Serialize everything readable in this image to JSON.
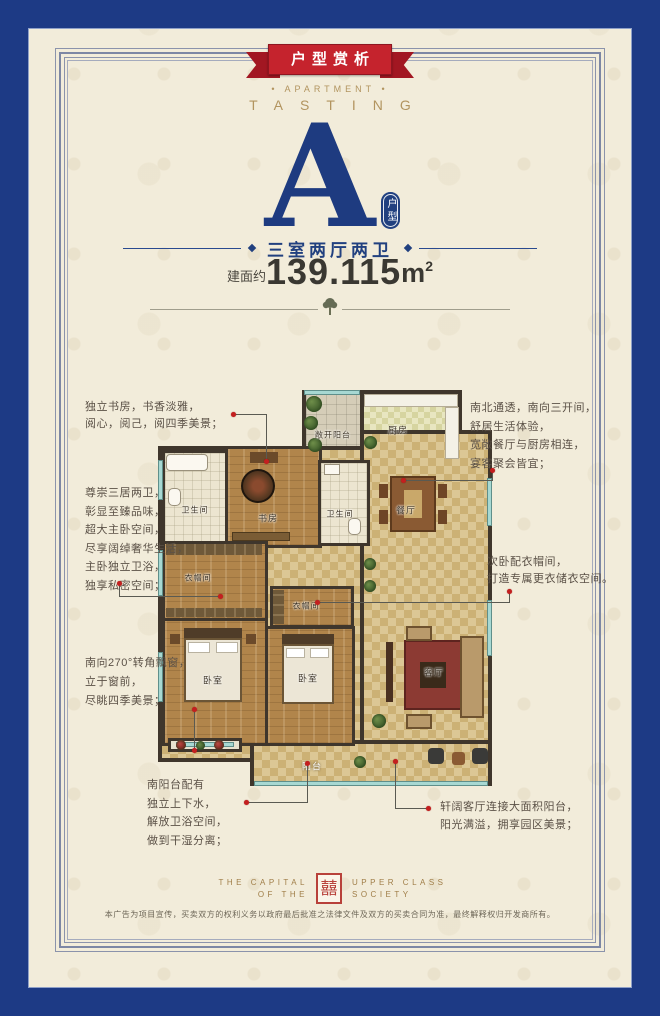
{
  "colors": {
    "frame_blue": "#1d3a85",
    "cream_background": "#f2ecda",
    "ribbon_red": "#c5232d",
    "navy_text": "#21407f",
    "gold_text": "#b2945f",
    "wall_dark": "#3f362c",
    "callout_red": "#c41f1f"
  },
  "banner": {
    "ribbon": "户型赏析",
    "apartment_line": "• APARTMENT •",
    "tasting_line": "TASTING"
  },
  "unit": {
    "letter": "A",
    "badge": "户型",
    "layout": "三室两厅两卫",
    "area_label": "建面约",
    "area_number": "139.115",
    "area_unit": "m",
    "area_exp": "2"
  },
  "plan": {
    "rooms": {
      "open_balcony": "敞开阳台",
      "kitchen": "厨房",
      "bath1": "卫生间",
      "study": "书房",
      "bath2": "卫生间",
      "dining": "餐厅",
      "closet1": "衣帽间",
      "closet2": "衣帽间",
      "bedroom1": "卧室",
      "bedroom2": "卧室",
      "living": "客厅",
      "balcony": "阳台"
    }
  },
  "annotations": {
    "a1": {
      "lines": [
        "独立书房，书香淡雅，",
        "阅心，阅己，阅四季美景；"
      ]
    },
    "a2": {
      "lines": [
        "尊崇三居两卫，",
        "彰显至臻品味，",
        "超大主卧空间，",
        "尽享阔绰奢华生活，",
        "主卧独立卫浴，",
        "独享私密空间；"
      ]
    },
    "a3": {
      "lines": [
        "南向270°转角飘窗，",
        "立于窗前，",
        "尽眺四季美景；"
      ]
    },
    "a4": {
      "lines": [
        "南阳台配有",
        "独立上下水，",
        "解放卫浴空间，",
        "做到干湿分离；"
      ]
    },
    "b1": {
      "lines": [
        "南北通透，南向三开间，",
        "舒居生活体验，",
        "宽敞餐厅与厨房相连，",
        "宴客聚会皆宜；"
      ]
    },
    "b2": {
      "lines": [
        "次卧配衣帽间，",
        "打造专属更衣储衣空间。"
      ]
    },
    "b3": {
      "lines": [
        "轩阔客厅连接大面积阳台，",
        "阳光满溢，拥享园区美景；"
      ]
    }
  },
  "footer": {
    "brand_left1": "THE CAPITAL",
    "brand_left2": "OF THE",
    "brand_right1": "UPPER CLASS",
    "brand_right2": "SOCIETY",
    "seal_glyph": "囍",
    "disclaimer": "本广告为项目宣传，买卖双方的权利义务以政府最后批准之法律文件及双方的买卖合同为准，最终解释权归开发商所有。"
  }
}
